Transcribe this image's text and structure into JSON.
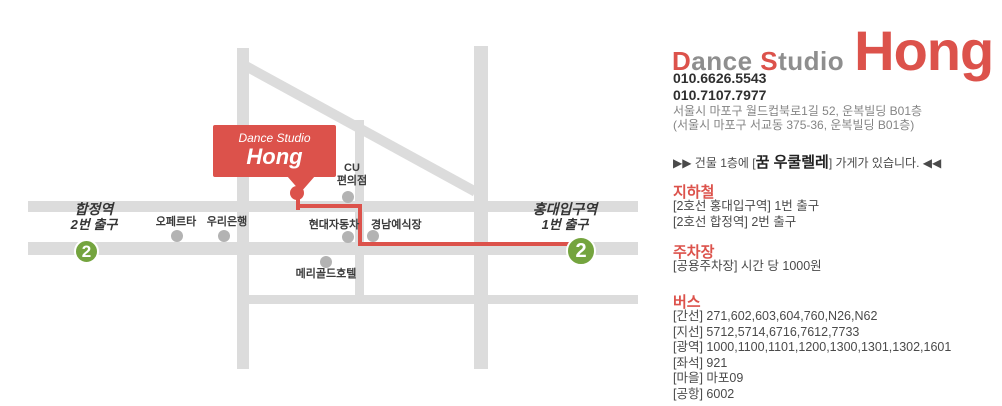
{
  "theme": {
    "accent_red": "#dc524b",
    "line_green": "#74a43e",
    "road_gray": "#dcdcdc",
    "dot_gray": "#b3b3b3"
  },
  "map": {
    "marker": {
      "line1": "Dance Studio",
      "line2": "Hong"
    },
    "stations": {
      "hapjeong": {
        "name": "합정역",
        "exit": "2번 출구",
        "line_badge": "2"
      },
      "hongdae": {
        "name": "홍대입구역",
        "exit": "1번 출구",
        "line_badge": "2"
      }
    },
    "cu": {
      "line1": "CU",
      "line2": "편의점"
    },
    "places": [
      {
        "label": "오페르타"
      },
      {
        "label": "우리은행"
      },
      {
        "label": "현대자동차"
      },
      {
        "label": "경남예식장"
      },
      {
        "label": "메리골드호텔"
      }
    ]
  },
  "brand": {
    "initial1": "D",
    "rest1": "ance",
    "initial2": "S",
    "rest2": "tudio",
    "big": "Hong"
  },
  "contact": {
    "phone1": "010.6626.5543",
    "phone2": "010.7107.7977",
    "address1": "서울시 마포구 월드컵북로1길 52, 운복빌딩 B01층",
    "address2": "(서울시 마포구 서교동 375-36, 운복빌딩 B01층)"
  },
  "notice": {
    "prefix": "▶▶ 건물 1층에 [",
    "highlight": "꿈 우쿨렐레",
    "suffix": "] 가게가 있습니다. ◀◀"
  },
  "subway": {
    "heading": "지하철",
    "items": [
      "[2호선 홍대입구역] 1번 출구",
      "[2호선 합정역] 2번 출구"
    ]
  },
  "parking": {
    "heading": "주차장",
    "items": [
      "[공용주차장] 시간 당 1000원"
    ]
  },
  "bus": {
    "heading": "버스",
    "items": [
      "[간선] 271,602,603,604,760,N26,N62",
      "[지선] 5712,5714,6716,7612,7733",
      "[광역] 1000,1100,1101,1200,1300,1301,1302,1601",
      "[좌석] 921",
      "[마을] 마포09",
      "[공항] 6002"
    ]
  }
}
